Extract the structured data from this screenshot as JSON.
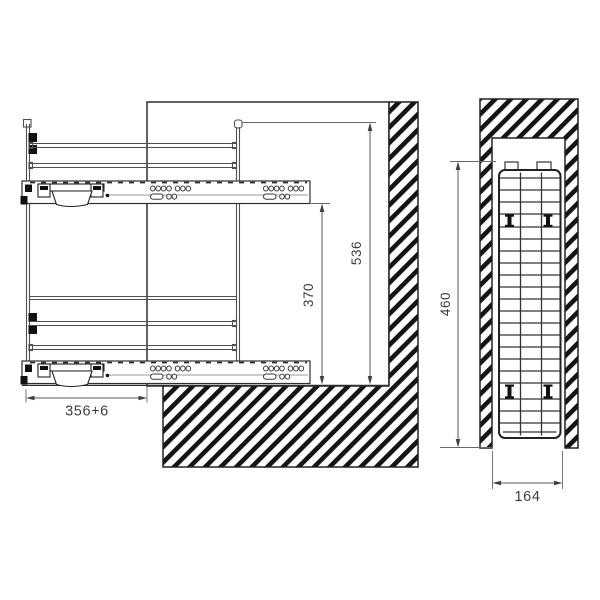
{
  "drawing": {
    "title": "pull-out basket installation drawing",
    "side_view": {
      "dim_total_height": "536",
      "dim_inner_height": "370",
      "dim_pullout": "356+6"
    },
    "front_view": {
      "dim_height": "460",
      "dim_width": "164"
    },
    "colors": {
      "background": "#ffffff",
      "line": "#2f2f2f",
      "hatch": "#141414",
      "dim_text": "#3e3e3e"
    }
  }
}
